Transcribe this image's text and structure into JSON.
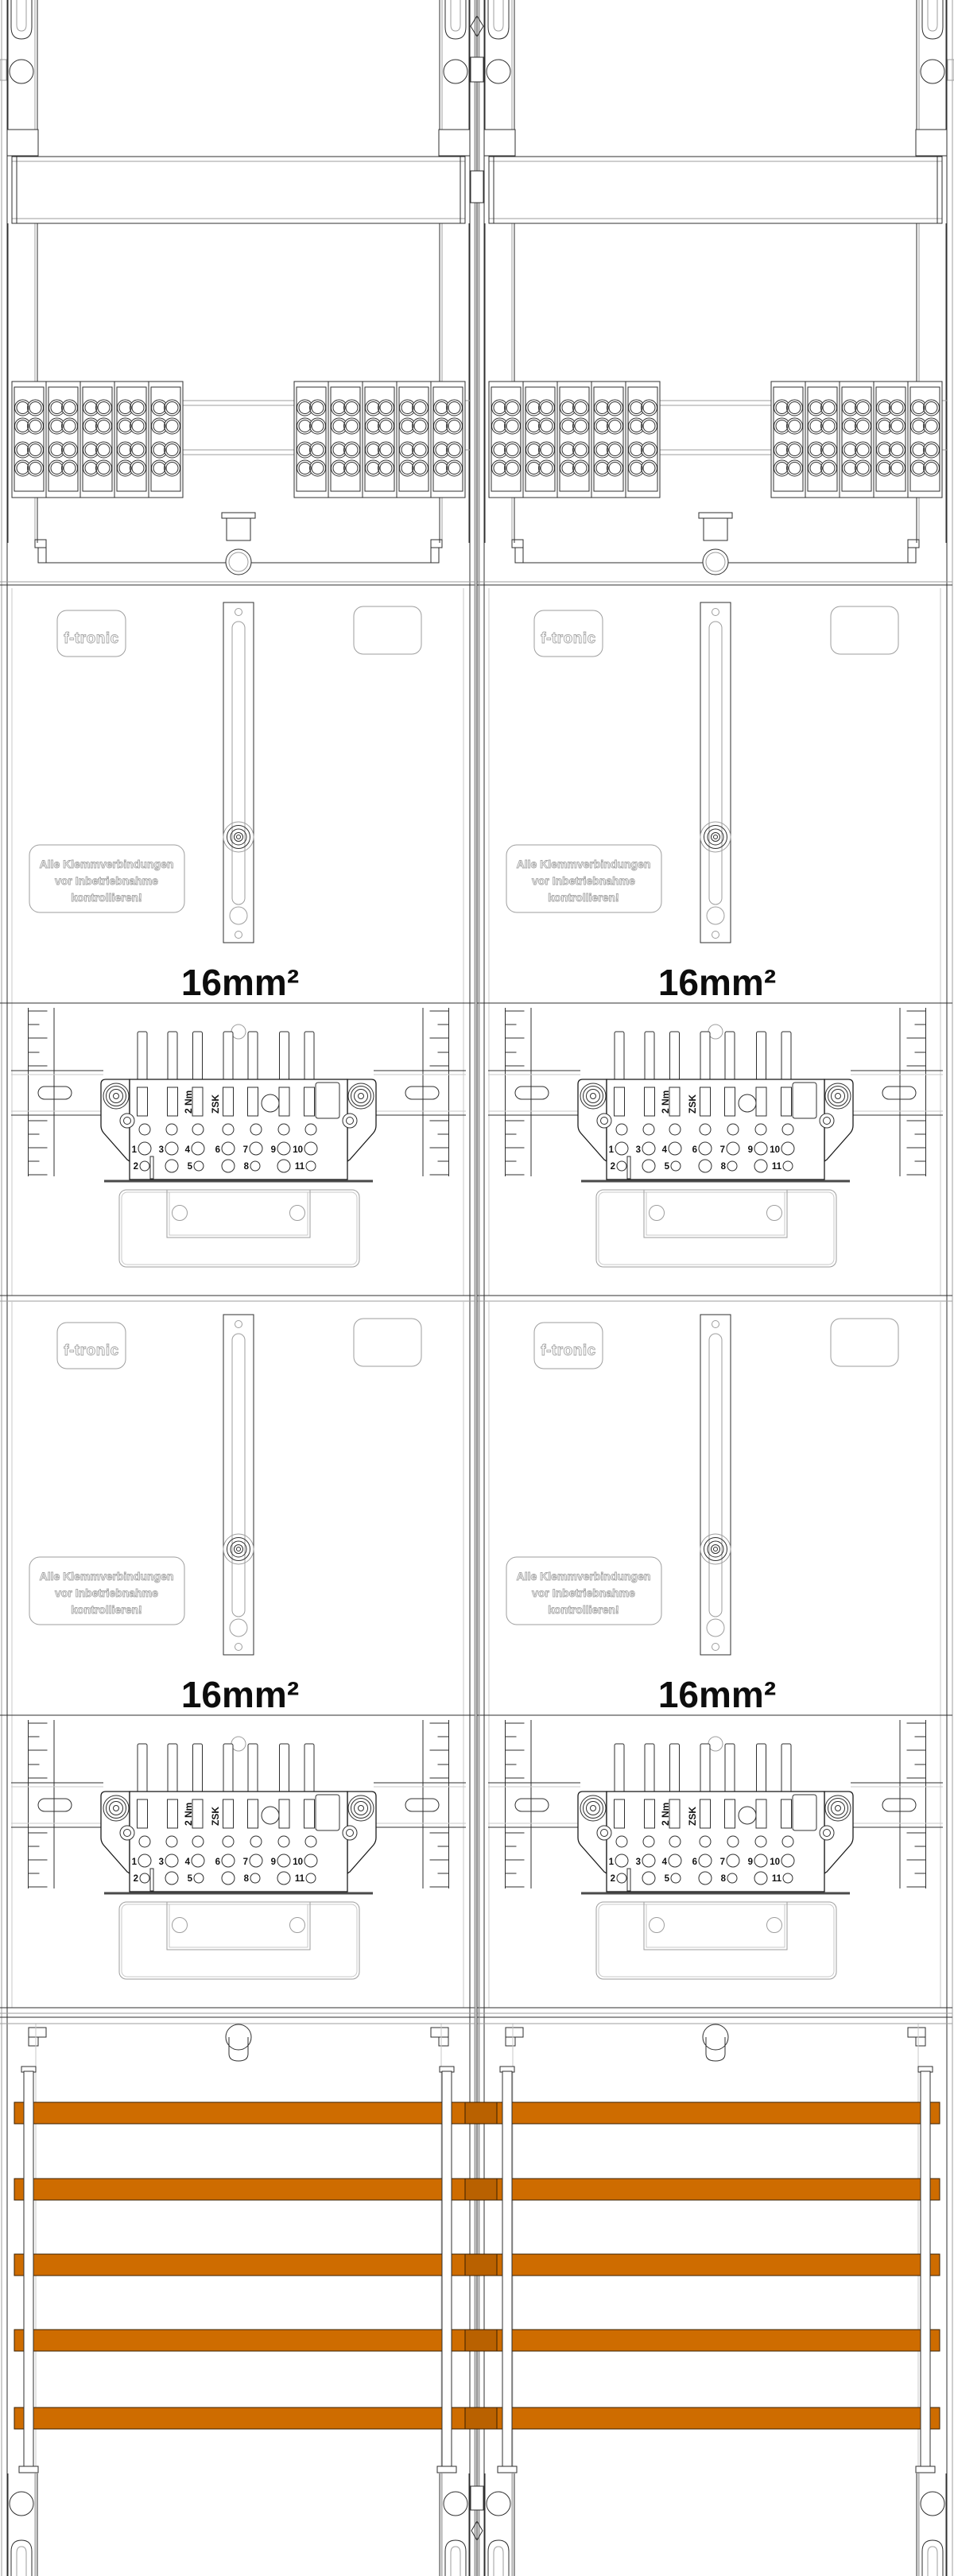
{
  "drawing": {
    "brand": "f-tronic",
    "warning_lines": [
      "Alle Klemmverbindungen",
      "vor Inbetriebnahme",
      "kontrollieren!"
    ],
    "wire_label": "16mm²",
    "torque_label": "2 Nm",
    "type_label": "ZSK",
    "terminal_numbers_row1": [
      "1",
      "3",
      "4",
      "6",
      "7",
      "9",
      "10"
    ],
    "terminal_numbers_row2": [
      "2",
      "5",
      "8",
      "11"
    ],
    "colors": {
      "busbar": "#CE6C00",
      "busbar_edge": "#3a2000",
      "line_dark": "#2f2f2f",
      "line_light": "#9e9e9e"
    }
  }
}
